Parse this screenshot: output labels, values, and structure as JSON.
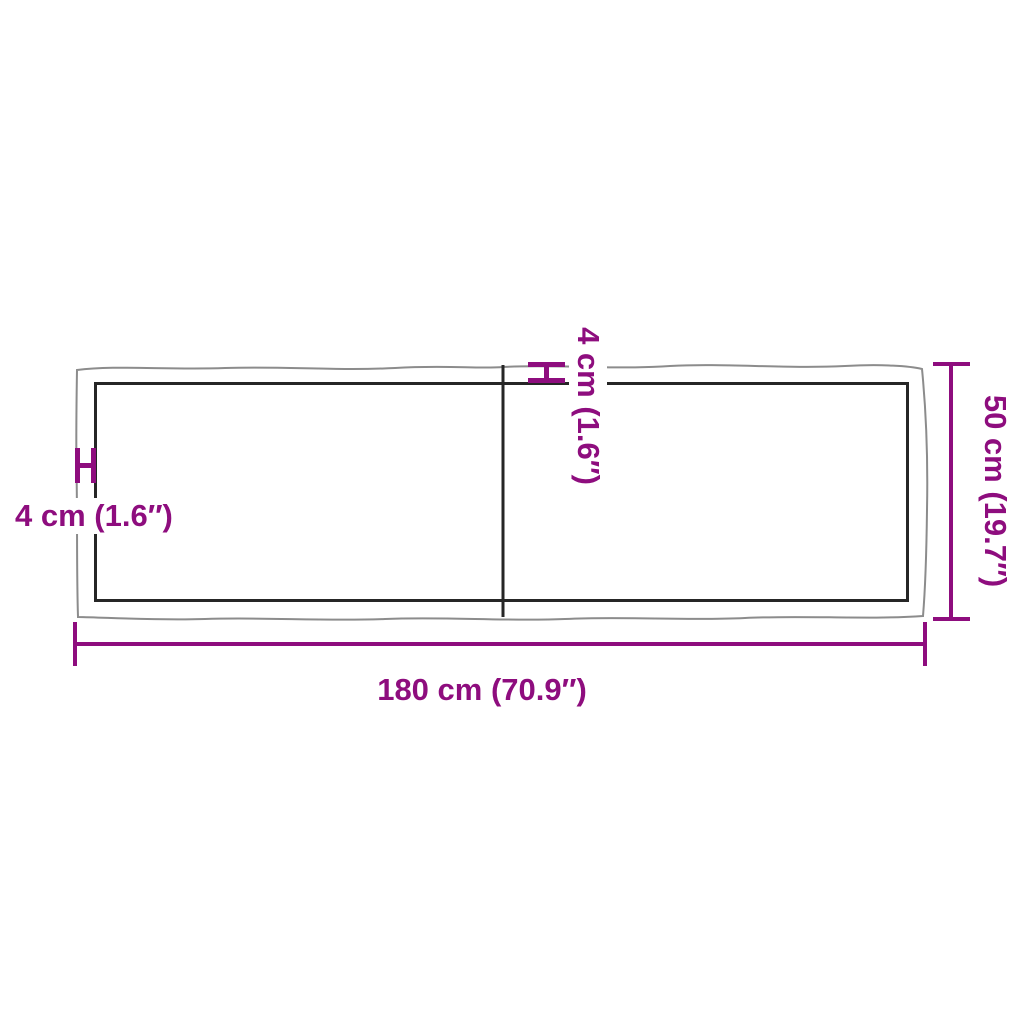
{
  "diagram": {
    "description": "Top view dimension drawing of a live-edge wooden table top made of two boards",
    "labels": {
      "length": "180 cm (70.9″)",
      "depth": "50 cm (19.7″)",
      "thickness_left": "4 cm (1.6″)",
      "thickness_top": "4 cm (1.6″)"
    },
    "measurements": {
      "length_cm": 180,
      "length_inch": 70.9,
      "depth_cm": 50,
      "depth_inch": 19.7,
      "edge_thickness_cm": 4,
      "edge_thickness_inch": 1.6
    },
    "colors": {
      "dimension_accent": "#8E0D7E",
      "outer_edge_line": "#8C8C8C",
      "inner_edge_line": "#262626",
      "background": "#FFFFFF"
    }
  }
}
